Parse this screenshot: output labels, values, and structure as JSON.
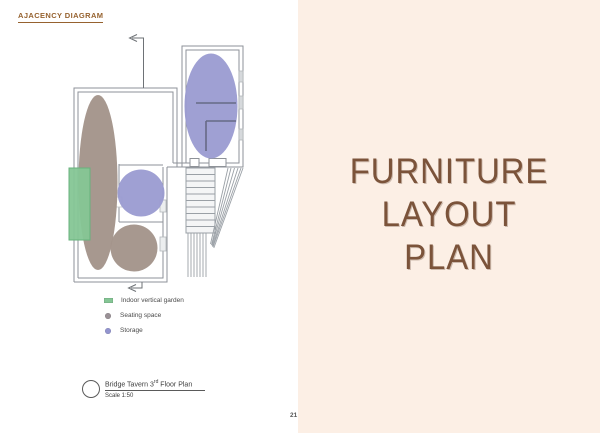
{
  "header": {
    "title": "AJACENCY DIAGRAM"
  },
  "plan": {
    "legend": {
      "items": [
        {
          "label": "Indoor vertical garden",
          "color": "#85c695"
        },
        {
          "label": "Seating space",
          "color": "#9a9196"
        },
        {
          "label": "Storage",
          "color": "#9395cf"
        }
      ]
    },
    "title_block": {
      "name_pre": "Bridge Tavern 3",
      "name_sup": "rd",
      "name_post": " Floor Plan",
      "scale": "Scale 1:50"
    }
  },
  "right_panel": {
    "heading_line1": "FURNITURE",
    "heading_line2": "LAYOUT",
    "heading_line3": "PLAN",
    "background": "#fcefe5",
    "text_color": "#7b533a"
  },
  "page_number": "21",
  "colors": {
    "accent_brown": "#96622f",
    "wall_gray": "#8e9298",
    "storage_purple": "#9a9bd1",
    "seating_taupe": "#a3948a",
    "garden_green": "#85c695"
  }
}
